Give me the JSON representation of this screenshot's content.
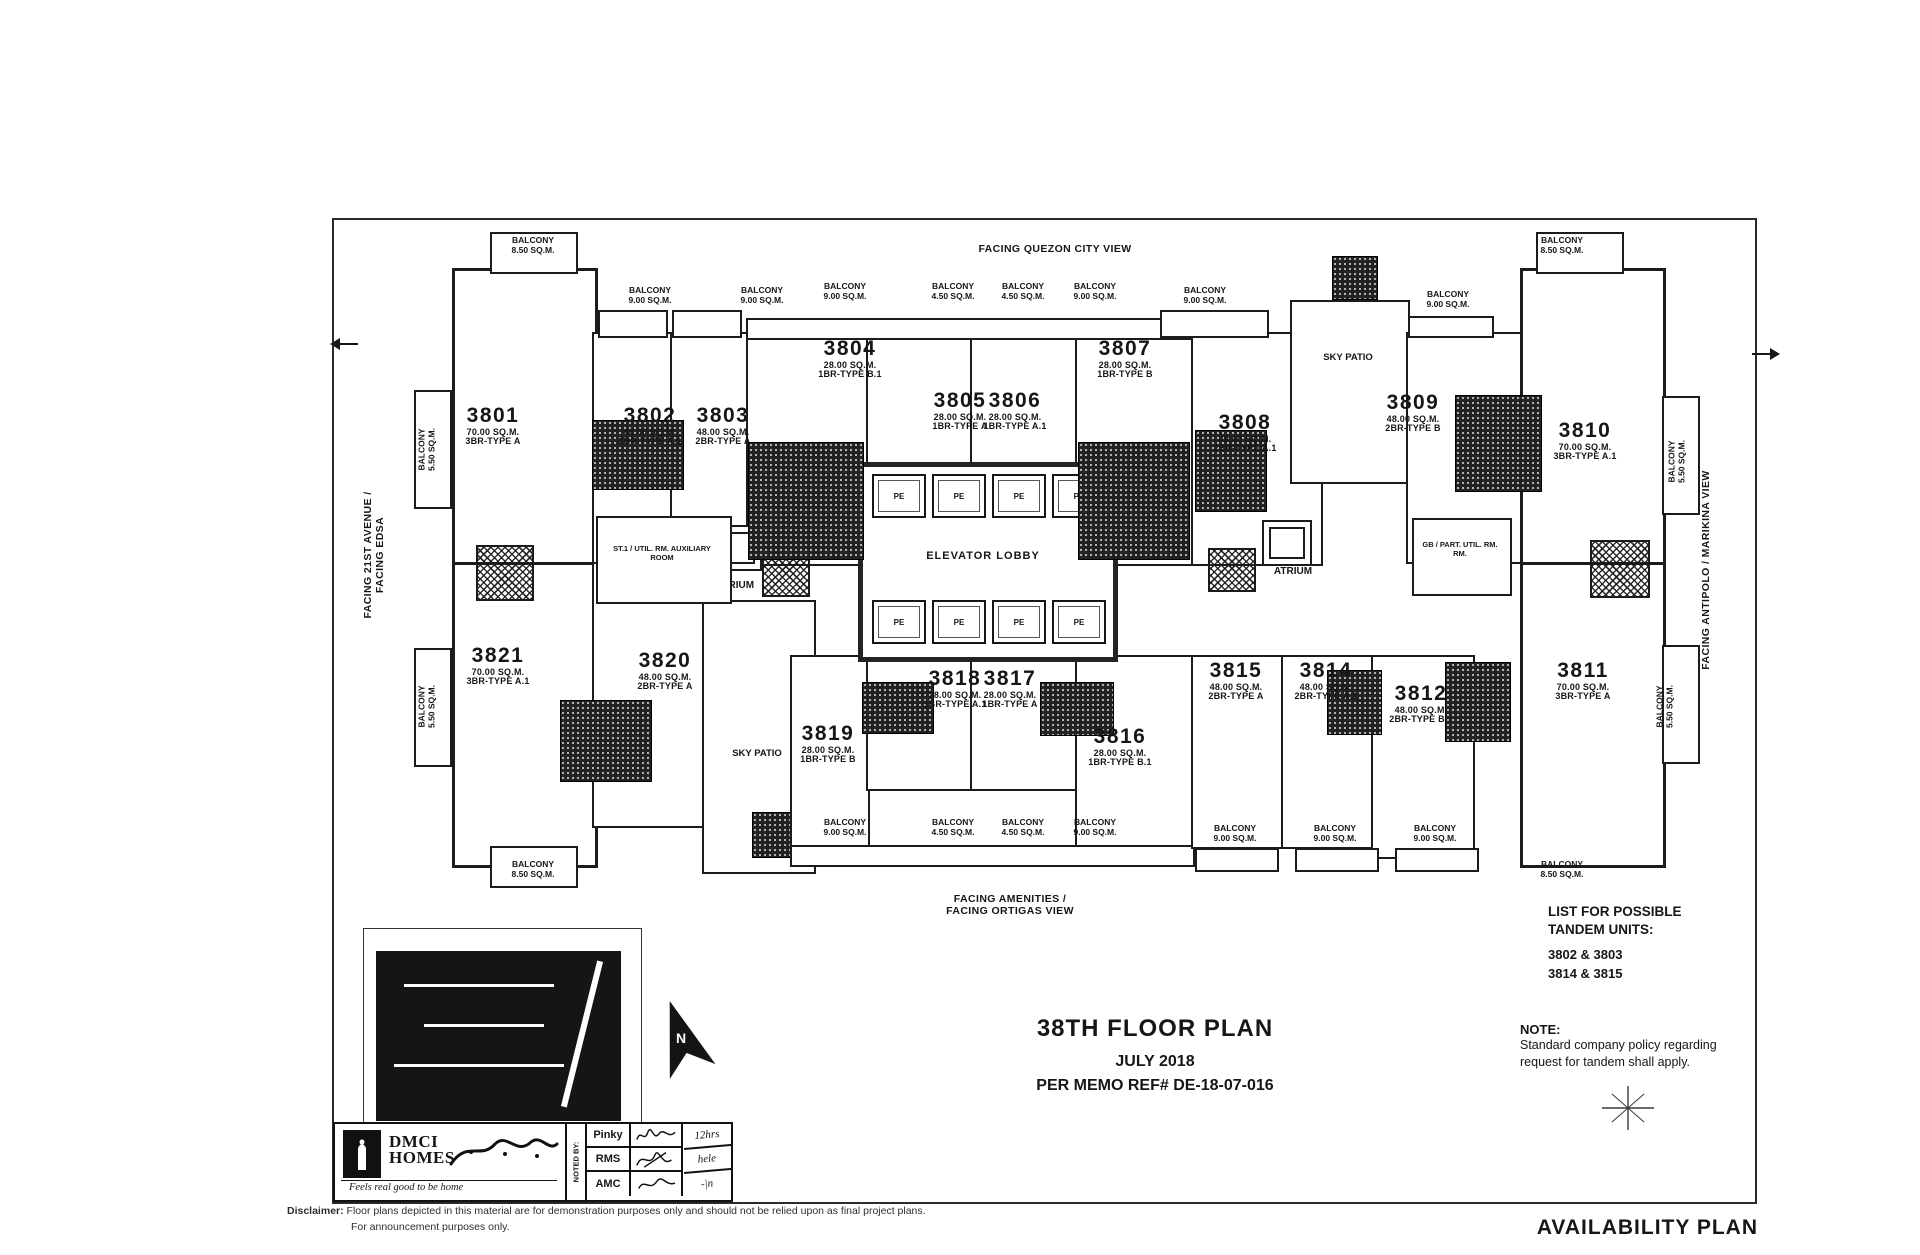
{
  "page": {
    "plan_title": "38TH FLOOR PLAN",
    "plan_date": "JULY 2018",
    "memo_ref": "PER MEMO REF# DE-18-07-016",
    "availability_plan": "AVAILABILITY PLAN"
  },
  "facing": {
    "top": "FACING QUEZON CITY VIEW",
    "left_line1": "FACING 21ST AVENUE /",
    "left_line2": "FACING EDSA",
    "right": "FACING ANTIPOLO / MARIKINA VIEW",
    "bottom_line1": "FACING AMENITIES /",
    "bottom_line2": "FACING ORTIGAS VIEW"
  },
  "labels": {
    "balcony": "BALCONY",
    "elevator_lobby": "ELEVATOR LOBBY",
    "atrium": "ATRIUM",
    "sky_patio": "SKY PATIO",
    "aux_left": "ST.1 / UTIL. RM. AUXILIARY ROOM",
    "aux_right": "GB / PART. UTIL. RM. RM.",
    "elevator_car": "PE",
    "north": "N"
  },
  "units": [
    {
      "number": "3801",
      "area": "70.00 SQ.M.",
      "type": "3BR-TYPE A"
    },
    {
      "number": "3802",
      "area": "48.00 SQ.M.",
      "type": "2BR-TYPE A.1"
    },
    {
      "number": "3803",
      "area": "48.00 SQ.M.",
      "type": "2BR-TYPE A"
    },
    {
      "number": "3804",
      "area": "28.00 SQ.M.",
      "type": "1BR-TYPE B.1"
    },
    {
      "number": "3805",
      "area": "28.00 SQ.M.",
      "type": "1BR-TYPE A"
    },
    {
      "number": "3806",
      "area": "28.00 SQ.M.",
      "type": "1BR-TYPE A.1"
    },
    {
      "number": "3807",
      "area": "28.00 SQ.M.",
      "type": "1BR-TYPE B"
    },
    {
      "number": "3808",
      "area": "48.00 SQ.M.",
      "type": "2BR-TYPE A.1"
    },
    {
      "number": "3809",
      "area": "48.00 SQ.M.",
      "type": "2BR-TYPE B"
    },
    {
      "number": "3810",
      "area": "70.00 SQ.M.",
      "type": "3BR-TYPE A.1"
    },
    {
      "number": "3821",
      "area": "70.00 SQ.M.",
      "type": "3BR-TYPE A.1"
    },
    {
      "number": "3820",
      "area": "48.00 SQ.M.",
      "type": "2BR-TYPE A"
    },
    {
      "number": "3819",
      "area": "28.00 SQ.M.",
      "type": "1BR-TYPE B"
    },
    {
      "number": "3818",
      "area": "28.00 SQ.M.",
      "type": "1BR-TYPE A.1"
    },
    {
      "number": "3817",
      "area": "28.00 SQ.M.",
      "type": "1BR-TYPE A"
    },
    {
      "number": "3816",
      "area": "28.00 SQ.M.",
      "type": "1BR-TYPE B.1"
    },
    {
      "number": "3815",
      "area": "48.00 SQ.M.",
      "type": "2BR-TYPE A"
    },
    {
      "number": "3814",
      "area": "48.00 SQ.M.",
      "type": "2BR-TYPE A.1"
    },
    {
      "number": "3812",
      "area": "48.00 SQ.M.",
      "type": "2BR-TYPE B.1"
    },
    {
      "number": "3811",
      "area": "70.00 SQ.M.",
      "type": "3BR-TYPE A"
    }
  ],
  "balconies": [
    "8.50 SQ.M.",
    "9.00 SQ.M.",
    "9.00 SQ.M.",
    "9.00 SQ.M.",
    "4.50 SQ.M.",
    "4.50 SQ.M.",
    "9.00 SQ.M.",
    "9.00 SQ.M.",
    "9.00 SQ.M.",
    "8.50 SQ.M.",
    "5.50 SQ.M.",
    "5.50 SQ.M.",
    "5.50 SQ.M.",
    "5.50 SQ.M.",
    "8.50 SQ.M.",
    "9.00 SQ.M.",
    "4.50 SQ.M.",
    "4.50 SQ.M.",
    "9.00 SQ.M.",
    "9.00 SQ.M.",
    "9.00 SQ.M.",
    "9.00 SQ.M.",
    "8.50 SQ.M."
  ],
  "tandem": {
    "line1": "LIST FOR POSSIBLE",
    "line2": "TANDEM UNITS:",
    "pairs": [
      "3802 & 3803",
      "3814 & 3815"
    ]
  },
  "note": {
    "title": "NOTE:",
    "line1": "Standard company policy regarding",
    "line2": "request for tandem shall apply."
  },
  "title_block": {
    "brand_top": "DMCI",
    "brand_bottom": "HOMES",
    "tagline": "Feels real good to be home",
    "noted_by": "NOTED BY:",
    "rows": [
      {
        "name": "Pinky",
        "remark": "12hrs"
      },
      {
        "name": "RMS",
        "remark": "hele"
      },
      {
        "name": "AMC",
        "remark": "-|n"
      }
    ]
  },
  "disclaimer": {
    "label": "Disclaimer:",
    "line1": "Floor plans depicted in this material are for demonstration purposes only and should not be relied upon as final project plans.",
    "line2": "For announcement purposes only."
  }
}
